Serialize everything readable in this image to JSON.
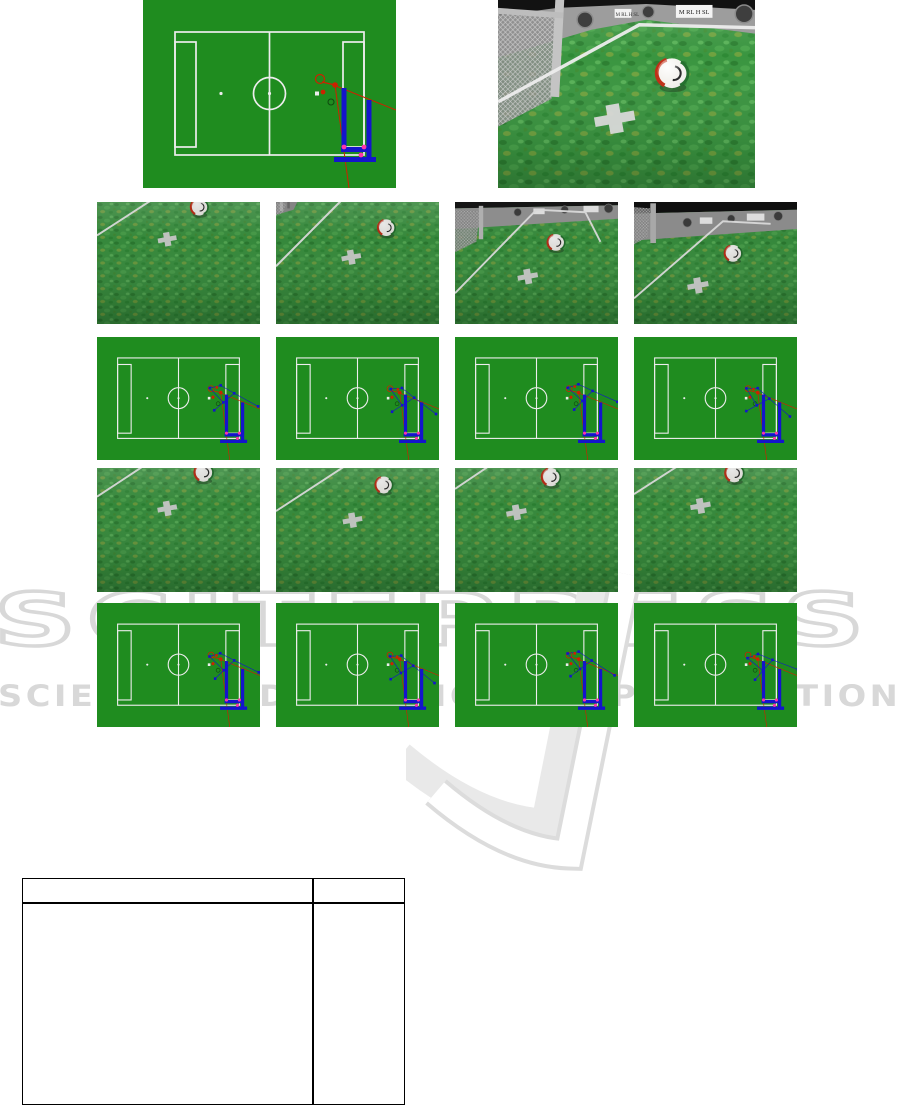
{
  "watermark": {
    "title": "SCITEPRESS",
    "subtitle": "SCIENCE AND TECHNOLOGY PUBLICATIONS"
  },
  "figures": {
    "top_left_field_map": {
      "type": "field-map"
    },
    "top_right_camera": {
      "type": "camera-view",
      "wall_logo_text": "M RL H SL"
    },
    "grid_rows": [
      {
        "panels": [
          "camera-view",
          "camera-view",
          "camera-view",
          "camera-view"
        ]
      },
      {
        "panels": [
          "field-map",
          "field-map",
          "field-map",
          "field-map"
        ]
      },
      {
        "panels": [
          "camera-view",
          "camera-view",
          "camera-view",
          "camera-view"
        ]
      },
      {
        "panels": [
          "field-map",
          "field-map",
          "field-map",
          "field-map"
        ]
      }
    ]
  },
  "table": {
    "header": [
      "",
      ""
    ],
    "rows": [
      [
        "",
        ""
      ]
    ]
  },
  "colors": {
    "field_green": "#1f8c1f",
    "grass_base": "#3a9540",
    "line_white": "#ededed",
    "particle_blue": "#1414cc",
    "trajectory_red": "#cc2200",
    "marker_magenta": "#ff33aa",
    "watermark_grey": "#d8d8d8"
  }
}
